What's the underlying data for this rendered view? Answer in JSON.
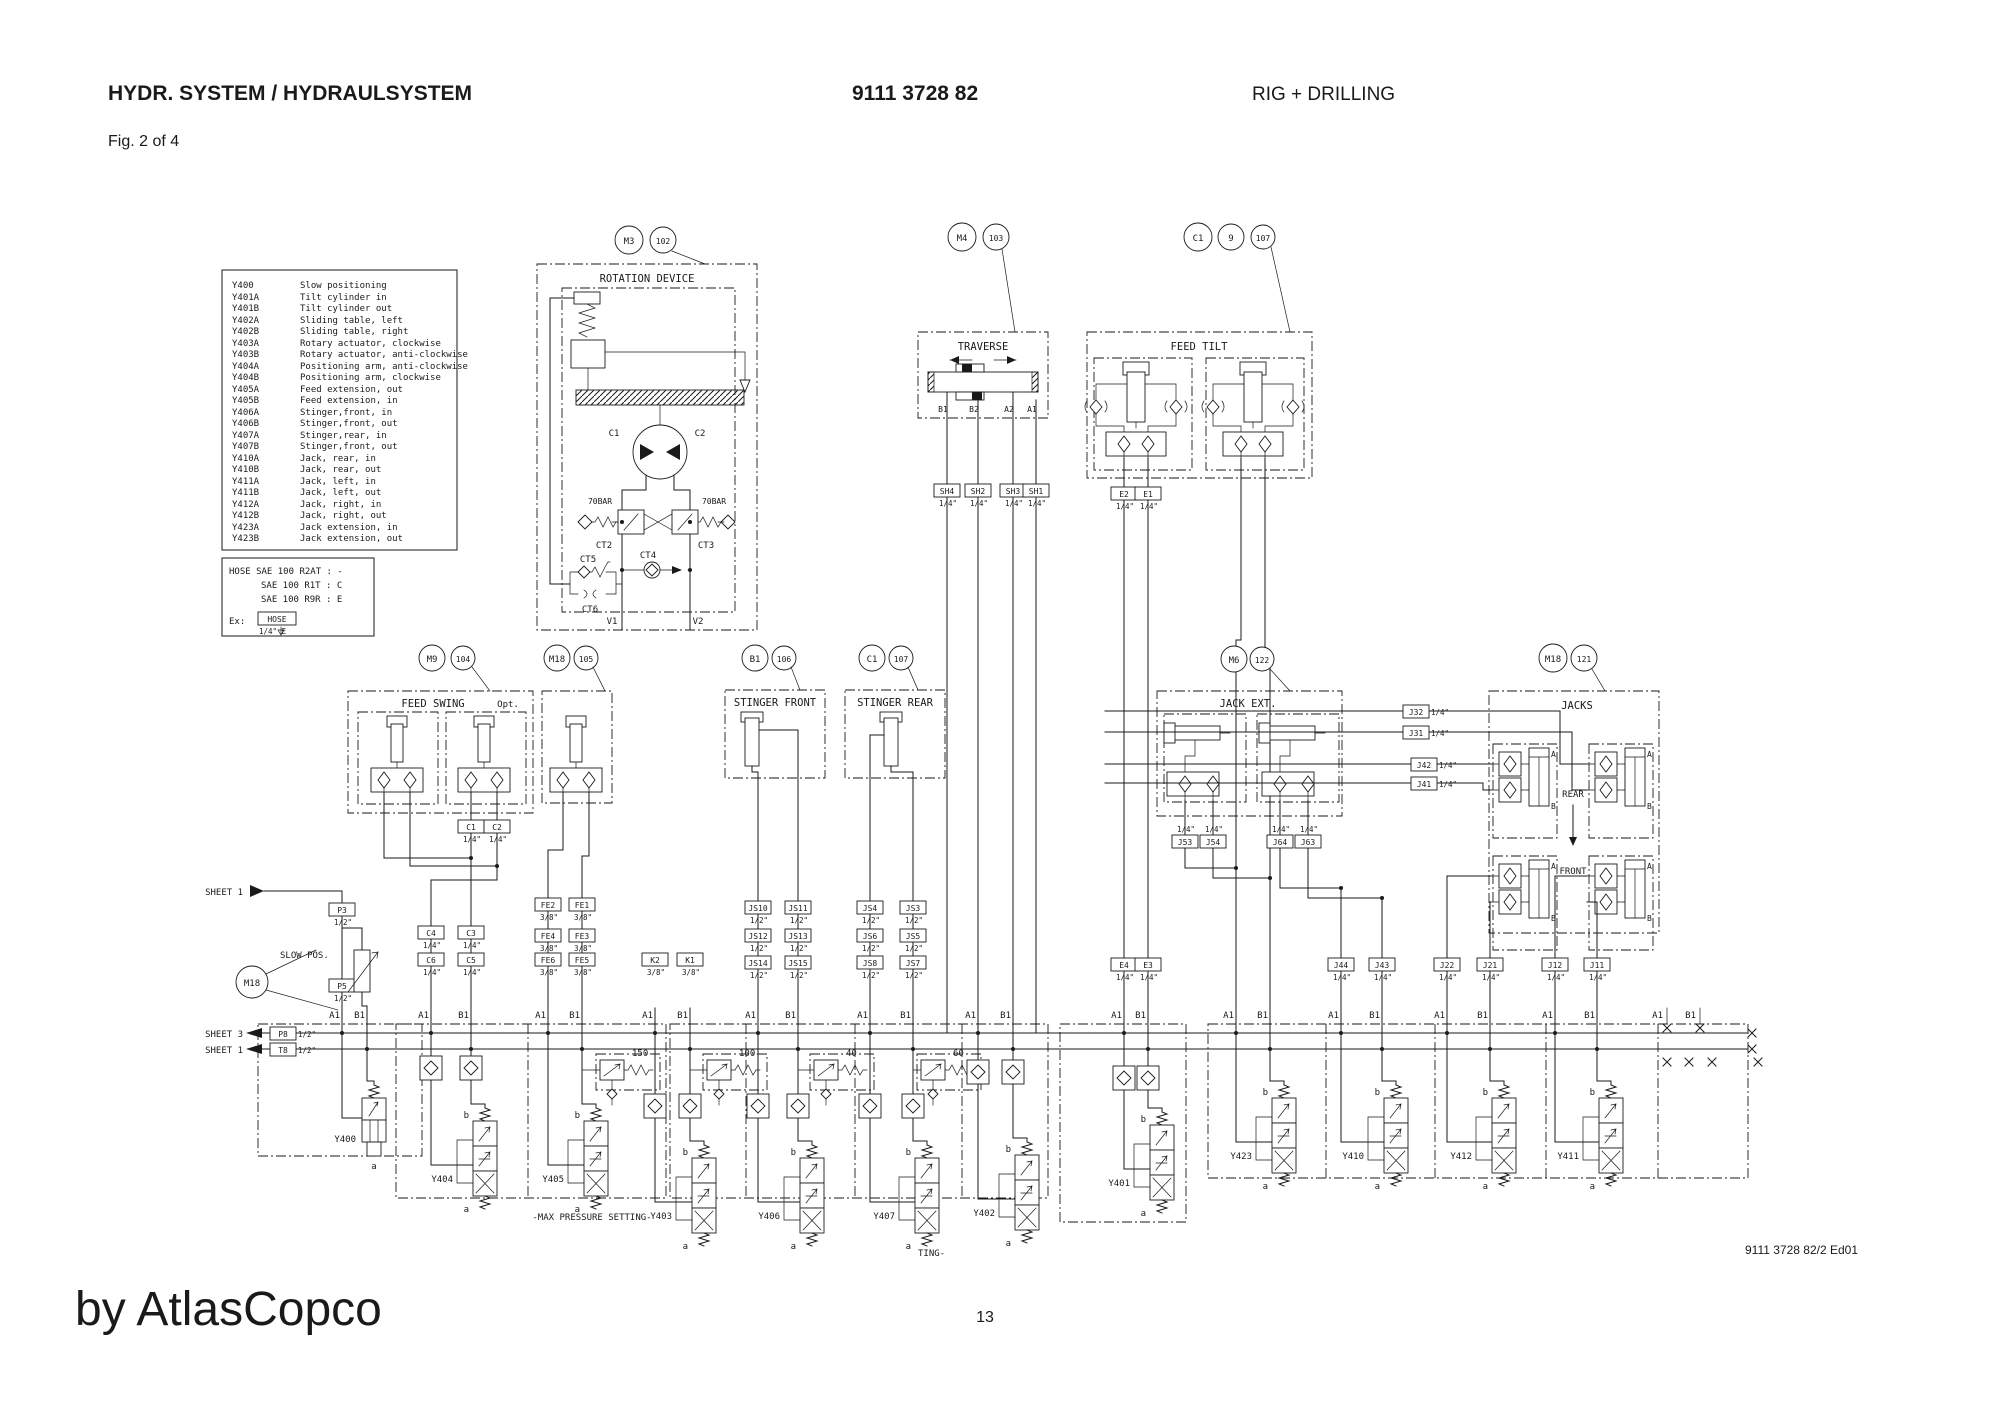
{
  "header": {
    "title": "HYDR. SYSTEM / HYDRAULSYSTEM",
    "doc_number": "9111 3728 82",
    "rig": "RIG + DRILLING",
    "fig": "Fig. 2 of 4",
    "page": "13",
    "edition": "9111 3728 82/2 Ed01",
    "watermark": "by AtlasCopco"
  },
  "legend": {
    "rows": [
      {
        "code": "Y400",
        "desc": "Slow positioning"
      },
      {
        "code": "Y401A",
        "desc": "Tilt cylinder in"
      },
      {
        "code": "Y401B",
        "desc": "Tilt cylinder out"
      },
      {
        "code": "Y402A",
        "desc": "Sliding table, left"
      },
      {
        "code": "Y402B",
        "desc": "Sliding table, right"
      },
      {
        "code": "Y403A",
        "desc": "Rotary actuator, clockwise"
      },
      {
        "code": "Y403B",
        "desc": "Rotary actuator, anti-clockwise"
      },
      {
        "code": "Y404A",
        "desc": "Positioning arm, anti-clockwise"
      },
      {
        "code": "Y404B",
        "desc": "Positioning arm, clockwise"
      },
      {
        "code": "Y405A",
        "desc": "Feed extension, out"
      },
      {
        "code": "Y405B",
        "desc": "Feed extension, in"
      },
      {
        "code": "Y406A",
        "desc": "Stinger,front, in"
      },
      {
        "code": "Y406B",
        "desc": "Stinger,front, out"
      },
      {
        "code": "Y407A",
        "desc": "Stinger,rear, in"
      },
      {
        "code": "Y407B",
        "desc": "Stinger,front, out"
      },
      {
        "code": "Y410A",
        "desc": "Jack, rear, in"
      },
      {
        "code": "Y410B",
        "desc": "Jack, rear, out"
      },
      {
        "code": "Y411A",
        "desc": "Jack, left, in"
      },
      {
        "code": "Y411B",
        "desc": "Jack, left, out"
      },
      {
        "code": "Y412A",
        "desc": "Jack, right, in"
      },
      {
        "code": "Y412B",
        "desc": "Jack, right, out"
      },
      {
        "code": "Y423A",
        "desc": "Jack extension, in"
      },
      {
        "code": "Y423B",
        "desc": "Jack extension, out"
      }
    ]
  },
  "hose": {
    "line1": "HOSE SAE 100 R2AT : -",
    "line2": "SAE 100 R1T : C",
    "line3": "SAE 100 R9R : E",
    "ex": "Ex:",
    "hose": "HOSE",
    "size": "1/4\" E"
  },
  "blocks": {
    "rotation": {
      "tag": "M3",
      "num": "102",
      "title": "ROTATION DEVICE",
      "c1": "C1",
      "c2": "C2",
      "bar_left": "70BAR",
      "bar_right": "70BAR",
      "ct2": "CT2",
      "ct3": "CT3",
      "ct4": "CT4",
      "ct5": "CT5",
      "ct6": "CT6",
      "v1": "V1",
      "v2": "V2"
    },
    "traverse": {
      "tag": "M4",
      "num": "103",
      "title": "TRAVERSE",
      "b1": "B1",
      "b2": "B2",
      "a2": "A2",
      "a1": "A1"
    },
    "feed_tilt": {
      "tag1": "C1",
      "tag2": "9",
      "num": "107",
      "title": "FEED TILT"
    },
    "feed_swing": {
      "tag": "M9",
      "num": "104",
      "title": "FEED SWING",
      "opt": "Opt."
    },
    "feed_ext": {
      "tag": "M18",
      "num": "105",
      "title": "FEED EXT."
    },
    "stinger_front": {
      "tag": "B1",
      "num": "106",
      "title": "STINGER FRONT"
    },
    "stinger_rear": {
      "tag": "C1",
      "num": "107",
      "title": "STINGER REAR"
    },
    "jack_ext": {
      "tag": "M6",
      "num": "122",
      "title": "JACK EXT."
    },
    "jacks": {
      "tag": "M18",
      "num": "121",
      "title": "JACKS",
      "rear": "REAR",
      "front": "FRONT",
      "port_a": "A",
      "port_b": "B"
    }
  },
  "ports": [
    {
      "id": "P3",
      "size": "1/2\""
    },
    {
      "id": "P5",
      "size": "1/2\""
    },
    {
      "id": "P8",
      "size": "1/2\""
    },
    {
      "id": "T8",
      "size": "1/2\""
    },
    {
      "id": "C4",
      "size": "1/4\""
    },
    {
      "id": "C3",
      "size": "1/4\""
    },
    {
      "id": "C6",
      "size": "1/4\""
    },
    {
      "id": "C5",
      "size": "1/4\""
    },
    {
      "id": "FE2",
      "size": "3/8\""
    },
    {
      "id": "FE1",
      "size": "3/8\""
    },
    {
      "id": "FE4",
      "size": "3/8\""
    },
    {
      "id": "FE3",
      "size": "3/8\""
    },
    {
      "id": "FE6",
      "size": "3/8\""
    },
    {
      "id": "FE5",
      "size": "3/8\""
    },
    {
      "id": "K2",
      "size": "3/8\""
    },
    {
      "id": "K1",
      "size": "3/8\""
    },
    {
      "id": "JS10",
      "size": "1/2\""
    },
    {
      "id": "JS11",
      "size": "1/2\""
    },
    {
      "id": "JS12",
      "size": "1/2\""
    },
    {
      "id": "JS13",
      "size": "1/2\""
    },
    {
      "id": "JS14",
      "size": "1/2\""
    },
    {
      "id": "JS15",
      "size": "1/2\""
    },
    {
      "id": "JS4",
      "size": "1/2\""
    },
    {
      "id": "JS3",
      "size": "1/2\""
    },
    {
      "id": "JS6",
      "size": "1/2\""
    },
    {
      "id": "JS5",
      "size": "1/2\""
    },
    {
      "id": "JS8",
      "size": "1/2\""
    },
    {
      "id": "JS7",
      "size": "1/2\""
    },
    {
      "id": "SH4",
      "size": "1/4\""
    },
    {
      "id": "SH2",
      "size": "1/4\""
    },
    {
      "id": "SH3",
      "size": "1/4\""
    },
    {
      "id": "SH1",
      "size": "1/4\""
    },
    {
      "id": "E2",
      "size": "1/4\""
    },
    {
      "id": "E1",
      "size": "1/4\""
    },
    {
      "id": "E4",
      "size": "1/4\""
    },
    {
      "id": "E3",
      "size": "1/4\""
    },
    {
      "id": "J44",
      "size": "1/4\""
    },
    {
      "id": "J43",
      "size": "1/4\""
    },
    {
      "id": "J22",
      "size": "1/4\""
    },
    {
      "id": "J21",
      "size": "1/4\""
    },
    {
      "id": "J12",
      "size": "1/4\""
    },
    {
      "id": "J11",
      "size": "1/4\""
    },
    {
      "id": "J53",
      "size": "1/4\""
    },
    {
      "id": "J54",
      "size": "1/4\""
    },
    {
      "id": "J64",
      "size": "1/4\""
    },
    {
      "id": "J63",
      "size": "1/4\""
    },
    {
      "id": "J32",
      "size": "1/4\""
    },
    {
      "id": "J31",
      "size": "1/4\""
    },
    {
      "id": "J42",
      "size": "1/4\""
    },
    {
      "id": "J41",
      "size": "1/4\""
    },
    {
      "id": "C1",
      "size": "1/4\""
    },
    {
      "id": "C2",
      "size": "1/4\""
    }
  ],
  "stations": [
    {
      "a": "A1",
      "b": "B1",
      "y": "Y400"
    },
    {
      "a": "A1",
      "b": "B1",
      "y": "Y404"
    },
    {
      "a": "A1",
      "b": "B1",
      "y": "Y405"
    },
    {
      "a": "A1",
      "b": "B1",
      "y": "Y403"
    },
    {
      "a": "A1",
      "b": "B1",
      "y": "Y406"
    },
    {
      "a": "A1",
      "b": "B1",
      "y": "Y407"
    },
    {
      "a": "A1",
      "b": "B1",
      "y": "Y402"
    },
    {
      "a": "A1",
      "b": "B1",
      "y": "Y401"
    },
    {
      "a": "A1",
      "b": "B1",
      "y": "Y423"
    },
    {
      "a": "A1",
      "b": "B1",
      "y": "Y410"
    },
    {
      "a": "A1",
      "b": "B1",
      "y": "Y412"
    },
    {
      "a": "A1",
      "b": "B1",
      "y": "Y411"
    },
    {
      "a": "A1",
      "b": "B1"
    }
  ],
  "manifold": {
    "reliefs": [
      "150",
      "100",
      "40",
      "60"
    ],
    "max_pressure": "-MAX PRESSURE SETTING-",
    "ting": "TING-",
    "valve_a": "a",
    "valve_b": "b"
  },
  "left": {
    "sheet1_top": "SHEET 1",
    "sheet3": "SHEET 3",
    "sheet1": "SHEET 1",
    "slow_pos": "SLOW POS.",
    "m18": "M18"
  }
}
